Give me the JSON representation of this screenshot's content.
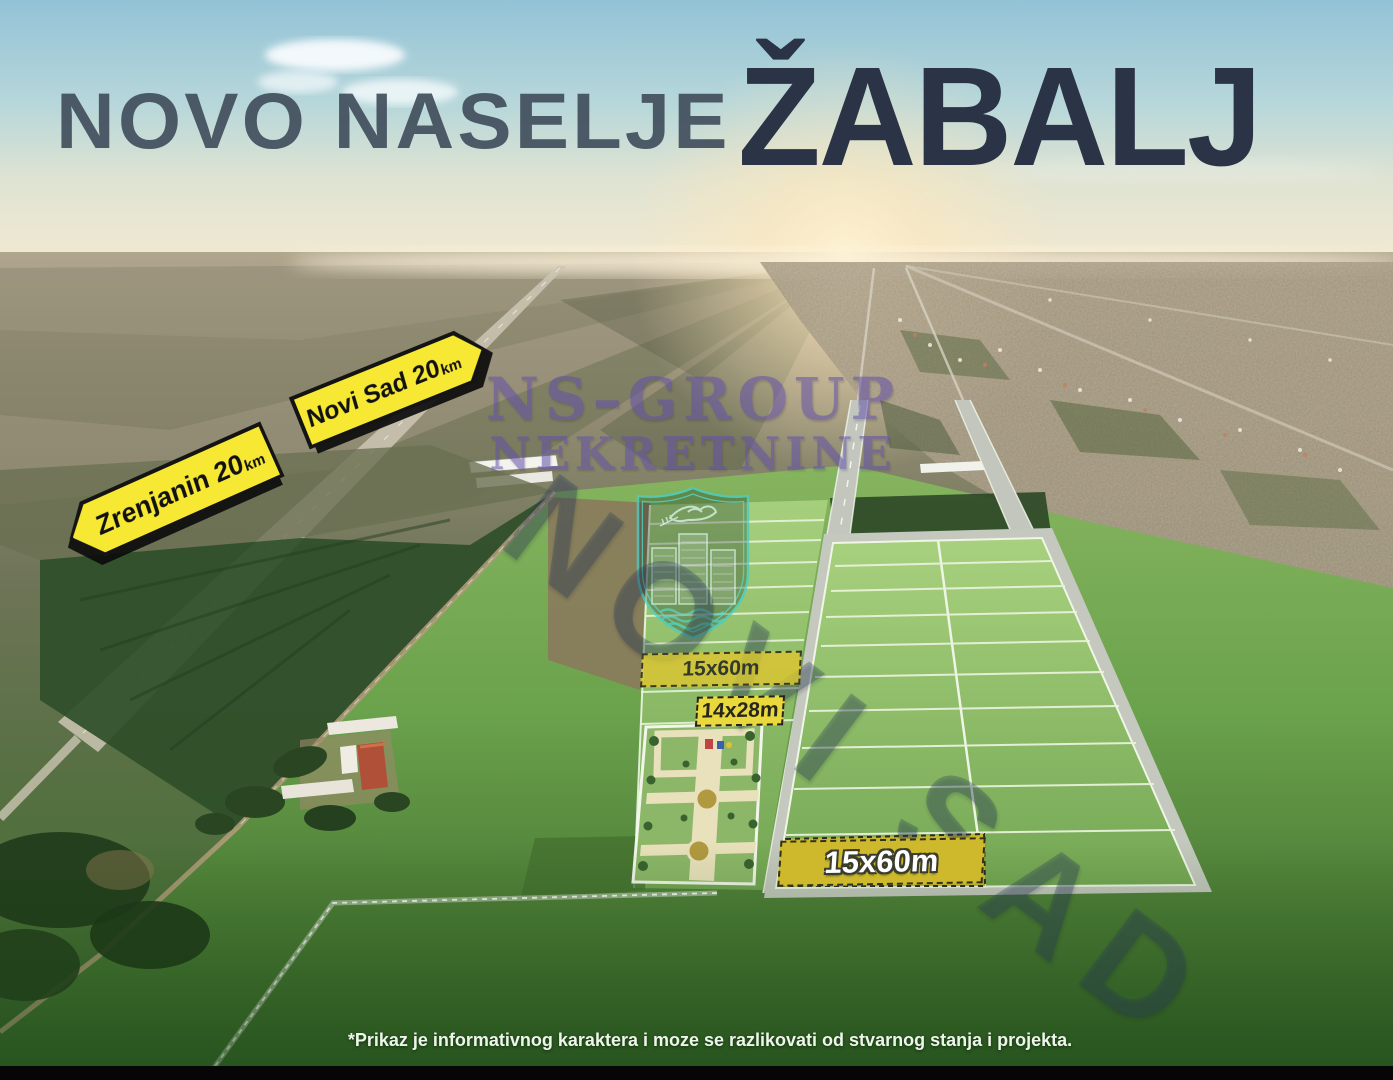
{
  "header": {
    "title_prefix": "NOVO NASELJE",
    "title_emphasis": "ŽABALJ"
  },
  "road_signs": [
    {
      "id": "zrenjanin",
      "label": "Zrenjanin 20",
      "unit": "km",
      "direction": "left"
    },
    {
      "id": "novi-sad",
      "label": "Novi Sad 20",
      "unit": "km",
      "direction": "right"
    }
  ],
  "watermark": {
    "company_line1": "NS–GROUP",
    "company_line2": "NEKRETNINE",
    "city": "NOVI SAD"
  },
  "plots": {
    "strip_label": "15x60m",
    "park_label": "14x28m",
    "highlight_label": "15x60m"
  },
  "disclaimer": "*Prikaz je informativnog karaktera i moze se razlikovati od stvarnog stanja i projekta.",
  "colors": {
    "sign_yellow": "#f7e833",
    "banner_yellow": "#cdb92b",
    "small_banner_yellow": "#ead93c",
    "title_light": "#43505e",
    "title_dark": "#2b3447",
    "watermark_purple": "#6250aa",
    "crest_teal": "#46cfc7",
    "diagonal_watermark_blue": "#2a405e",
    "plot_green": "#8fbc68",
    "disclaimer_text": "#eef5ea"
  }
}
